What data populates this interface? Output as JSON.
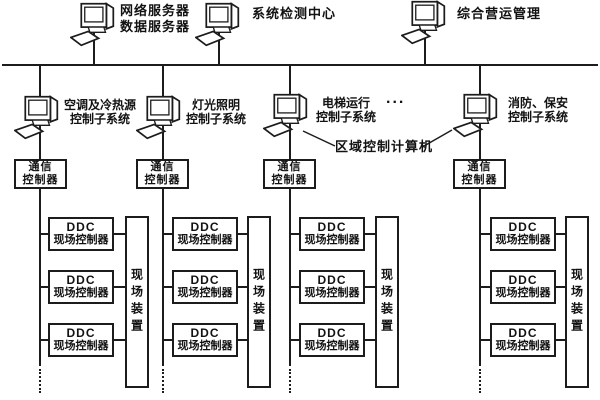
{
  "colors": {
    "background": "#ffffff",
    "line": "#1c1c1c",
    "text": "#121212"
  },
  "top_servers": [
    {
      "line1": "网络服务器",
      "line2": "数据服务器"
    },
    {
      "line1": "系统检测中心",
      "line2": ""
    },
    {
      "line1": "综合营运管理",
      "line2": ""
    }
  ],
  "subsystems": [
    {
      "line1": "空调及冷热源",
      "line2": "控制子系统"
    },
    {
      "line1": "灯光照明",
      "line2": "控制子系统"
    },
    {
      "line1": "电梯运行",
      "line2": "控制子系统"
    },
    {
      "line1": "消防、保安",
      "line2": "控制子系统"
    }
  ],
  "annotations": {
    "more_systems_ellipsis": "...",
    "regional_computer": "区域控制计算机"
  },
  "shared_labels": {
    "comm_line1": "通信",
    "comm_line2": "控制器",
    "ddc_line1": "DDC",
    "ddc_line2": "现场控制器",
    "field_device": "现场装置"
  }
}
